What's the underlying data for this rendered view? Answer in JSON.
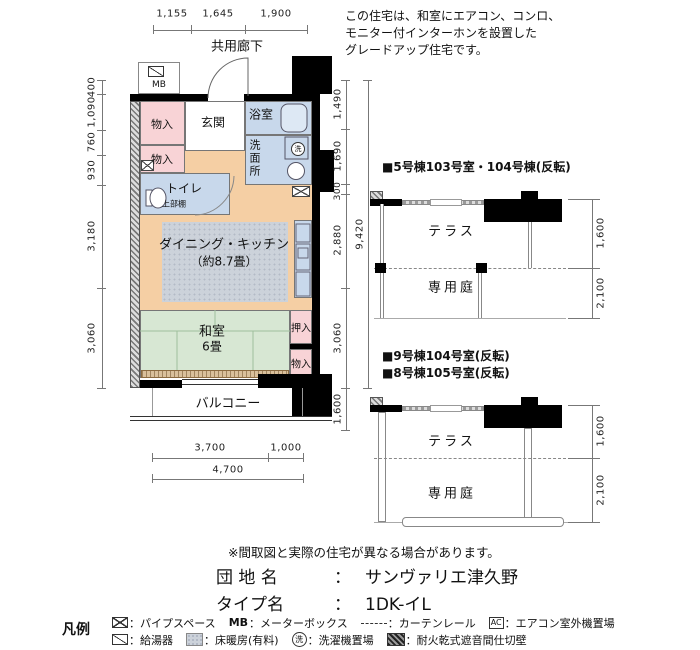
{
  "note": {
    "line1": "この住宅は、和室にエアコン、コンロ、",
    "line2": "モニター付インターホンを設置した",
    "line3": "グレードアップ住宅です。"
  },
  "plan": {
    "corridor": "共用廊下",
    "balcony": "バルコニー",
    "rooms": {
      "mb": "MB",
      "storage_a": "物入",
      "entrance": "玄関",
      "bath": "浴室",
      "storage_b": "物入",
      "toilet": "トイレ",
      "toilet_shelf": "上部棚",
      "washroom": "洗面所",
      "washer_mark": "洗",
      "dk_name": "ダイニング・キッチン",
      "dk_size": "（約8.7畳）",
      "tatami_room": "和室",
      "tatami_size": "6畳",
      "closet": "押入",
      "storage_c": "物入"
    },
    "dims": {
      "top": [
        "1,155",
        "1,645",
        "1,900"
      ],
      "left": [
        "400",
        "1,090",
        "760",
        "930",
        "3,180",
        "3,060"
      ],
      "right": [
        "1,490",
        "1,690",
        "300",
        "2,880",
        "3,060"
      ],
      "right_total": "9,420",
      "balcony_depth": "1,600",
      "bottom": [
        "3,700",
        "1,000"
      ],
      "bottom_total": "4,700"
    }
  },
  "variants": {
    "first": {
      "title": "■5号棟103号室・104号棟(反転)",
      "terrace": "テラス",
      "garden": "専用庭",
      "terrace_dim": "1,600",
      "garden_dim": "2,100"
    },
    "second": {
      "title1": "■9号棟104号室(反転)",
      "title2": "■8号棟105号室(反転)",
      "terrace": "テラス",
      "garden": "専用庭",
      "terrace_dim": "1,600",
      "garden_dim": "2,100"
    }
  },
  "footer": {
    "disclaimer": "※間取図と実際の住宅が異なる場合があります。",
    "estate_label": "団 地 名",
    "colon": "：",
    "estate_name": "サンヴァリエ津久野",
    "type_label": "タイプ名",
    "type_value": "1DK-イL"
  },
  "legend": {
    "title": "凡例",
    "pipe_space": "：パイプスペース",
    "mb_abbr": "MB",
    "mb": "：メーターボックス",
    "curtain": "：カーテンレール",
    "ac_abbr": "AC",
    "ac": "：エアコン室外機置場",
    "heater": "：給湯器",
    "floor_heating": "：床暖房(有料)",
    "washer_abbr": "洗",
    "washer": "：洗濯機置場",
    "firewall": "：耐火乾式遮音間仕切壁"
  },
  "colors": {
    "wall": "#000000",
    "dk_floor": "#f5cfa4",
    "tatami": "#d7e7d3",
    "wet_area": "#c8d8eb",
    "closet_pink": "#f8d3d6",
    "floor_heating_gray": "#ccd2da"
  }
}
